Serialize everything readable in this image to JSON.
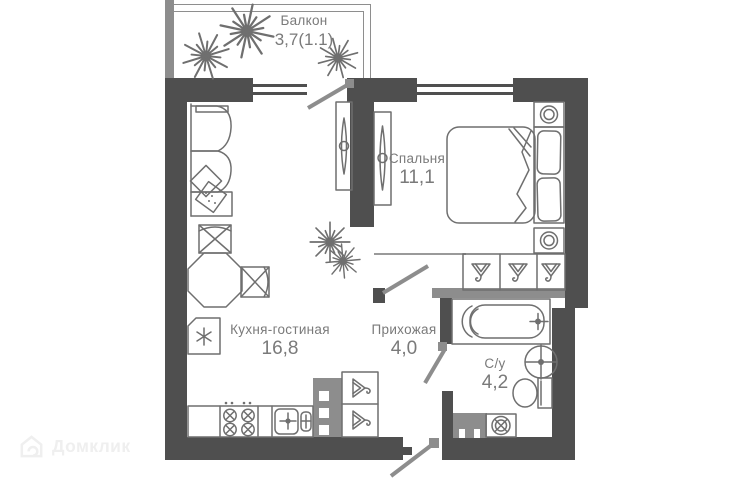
{
  "meta": {
    "width": 752,
    "height": 480,
    "kind": "apartment floor plan"
  },
  "rooms": {
    "balcony": {
      "name": "Балкон",
      "area": "3,7(1.1)"
    },
    "bedroom": {
      "name": "Спальня",
      "area": "11,1"
    },
    "kitchen_living": {
      "name": "Кухня-гостиная",
      "area": "16,8"
    },
    "hallway": {
      "name": "Прихожая",
      "area": "4,0"
    },
    "bathroom": {
      "name": "С/у",
      "area": "4,2"
    }
  },
  "watermark": {
    "brand": "Домклик"
  },
  "fixtures": {
    "balcony": [
      "plant",
      "plant",
      "plant"
    ],
    "kitchen_living": [
      "sofa",
      "sofa-pillows",
      "dining-table",
      "chair",
      "chair",
      "fridge",
      "kitchen-counter",
      "stove",
      "kitchen-sink",
      "tv-stand",
      "plant",
      "hall-wardrobe",
      "vent-shaft"
    ],
    "bedroom": [
      "double-bed",
      "pillow",
      "pillow",
      "nightstand-lamp",
      "nightstand-lamp",
      "dresser-tv",
      "wardrobe-3-sections"
    ],
    "bathroom": [
      "bathtub",
      "washbasin",
      "toilet",
      "washing-machine",
      "vent-shaft"
    ],
    "doors": [
      "balcony-door",
      "bedroom-door",
      "bathroom-door",
      "entrance-door"
    ],
    "windows": [
      "kitchen-window",
      "bedroom-window"
    ]
  },
  "colors": {
    "wall_dark": "#4f4f4f",
    "wall_medium": "#8d8d8d",
    "furniture_line": "#6f6f6f",
    "label_text": "#7a7a7a",
    "background": "#ffffff",
    "watermark": "#efefef"
  }
}
